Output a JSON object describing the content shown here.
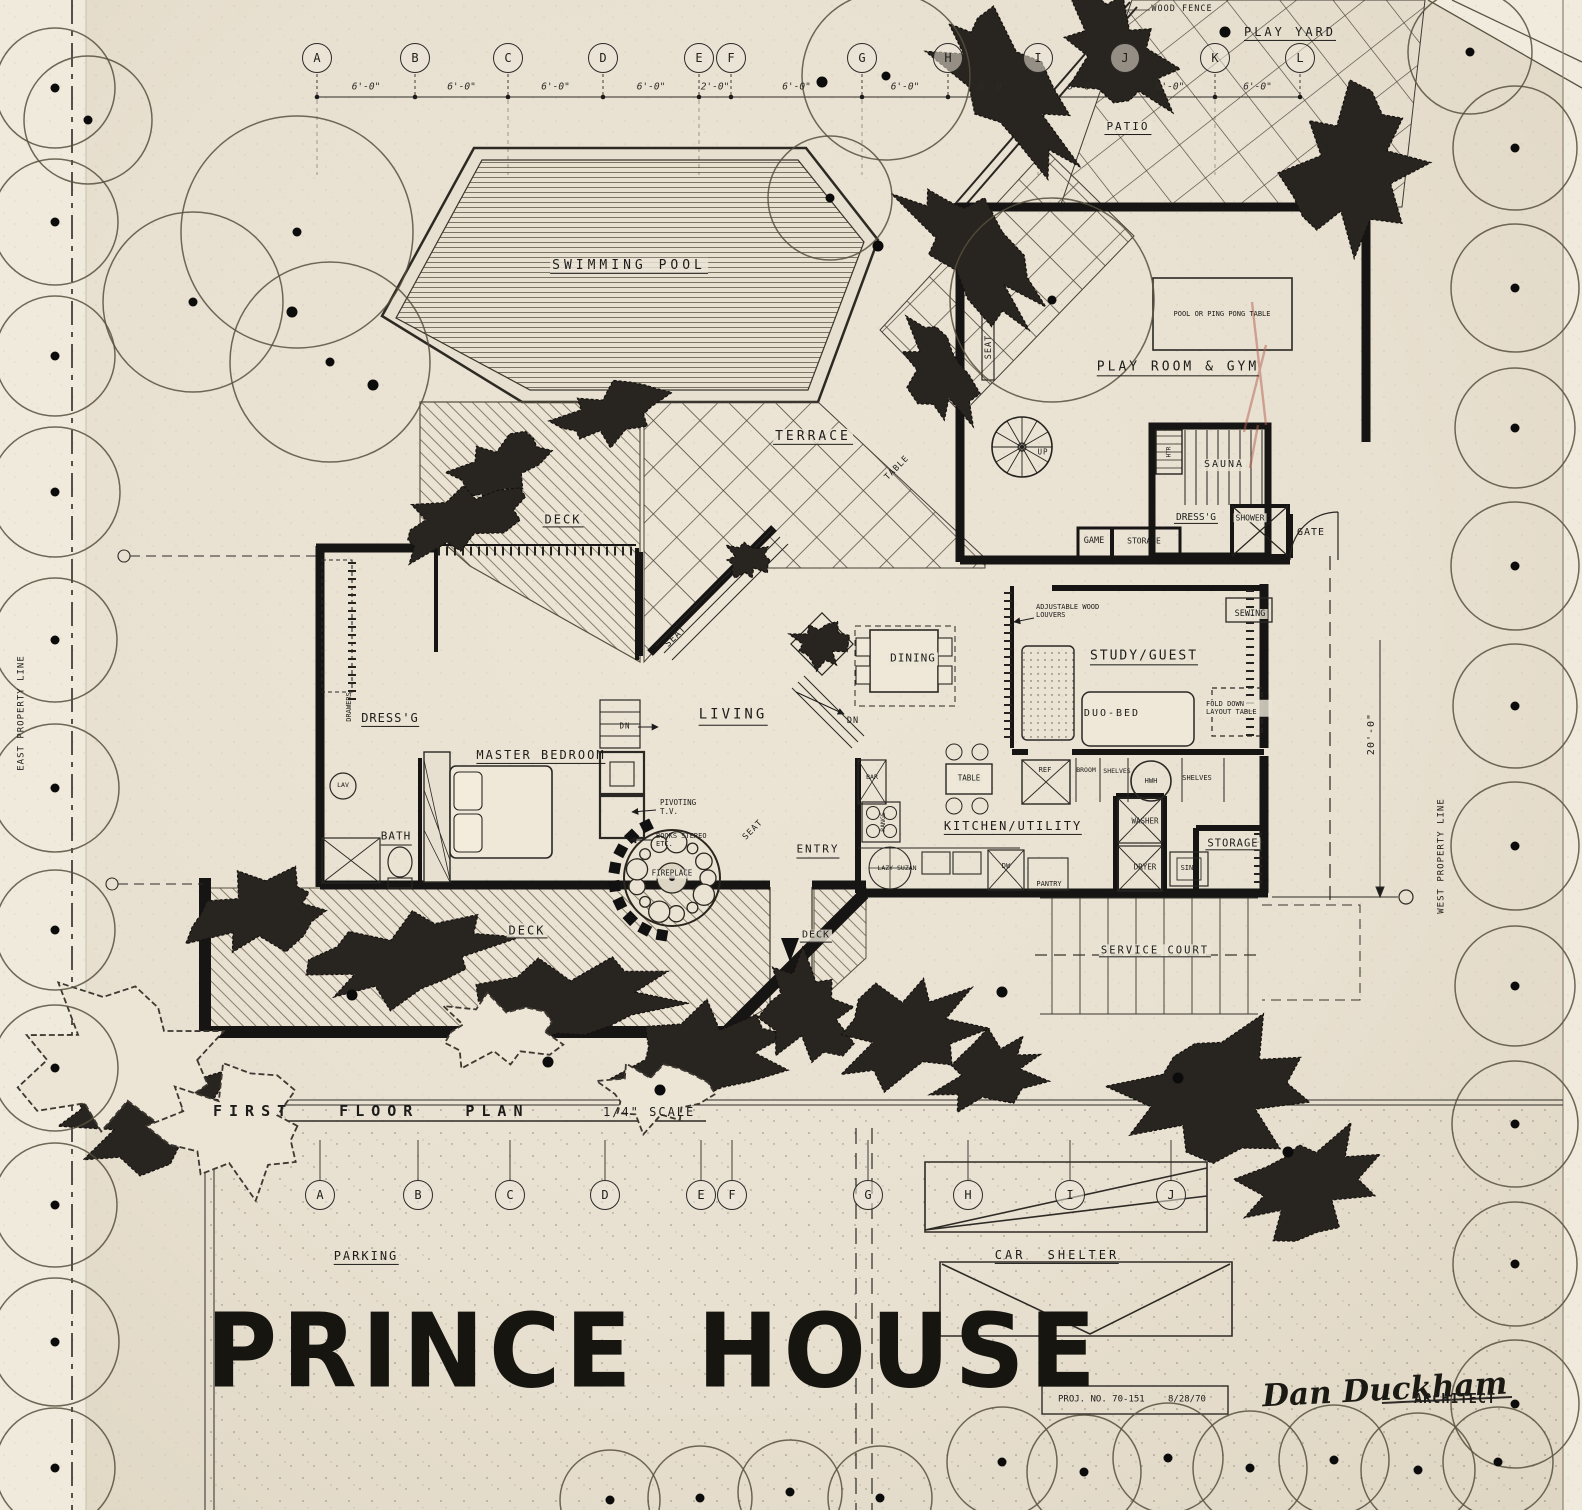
{
  "colors": {
    "paper": "#eae2d2",
    "ink": "#1c1c1c",
    "red_pencil": "#b2604f"
  },
  "title_block": {
    "title": "PRINCE HOUSE",
    "project_no": "PROJ. NO. 70-151",
    "date": "8/28/70",
    "signature": "Dan Duckham",
    "architect": "ARCHITECT"
  },
  "plan_title": {
    "name": "FIRST FLOOR PLAN",
    "scale": "1/4\" SCALE"
  },
  "grid": {
    "top_letters": [
      "A",
      "B",
      "C",
      "D",
      "E",
      "F",
      "G",
      "H",
      "I",
      "J",
      "K",
      "L"
    ],
    "top_dims": [
      "6'-0\"",
      "6'-0\"",
      "6'-0\"",
      "6'-0\"",
      "2'-0\"",
      "6'-0\"",
      "6'-0\"",
      "6'-0\"",
      "6'-0\"",
      "6'-0\"",
      "6'-0\""
    ],
    "bottom_letters": [
      "A",
      "B",
      "C",
      "D",
      "E",
      "F",
      "G",
      "H",
      "I",
      "J"
    ]
  },
  "site": {
    "wood_fence": "WOOD FENCE",
    "play_yard": "PLAY YARD",
    "patio": "PATIO",
    "gate": "GATE",
    "service_court": "SERVICE COURT",
    "parking": "PARKING",
    "car_shelter": "CAR SHELTER",
    "east_property_line": "EAST PROPERTY LINE",
    "west_property_line": "WEST PROPERTY LINE",
    "dim_20ft": "20'-0\""
  },
  "rooms": {
    "swimming_pool": "SWIMMING POOL",
    "terrace": "TERRACE",
    "deck": "DECK",
    "play_room": "PLAY ROOM & GYM",
    "sauna": "SAUNA",
    "living": "LIVING",
    "dining": "DINING",
    "entry": "ENTRY",
    "master_bedroom": "MASTER BEDROOM",
    "dressing": "DRESS'G",
    "bath": "BATH",
    "kitchen_utility": "KITCHEN/UTILITY",
    "study_guest": "STUDY/GUEST",
    "storage": "STORAGE"
  },
  "annotations": {
    "pool_table": "POOL OR PING PONG TABLE",
    "table": "TABLE",
    "seat": "SEAT",
    "up": "UP",
    "dn": "DN",
    "dress_outdoor": "DRESS'G",
    "shower": "SHOWER",
    "game": "GAME",
    "storage_small": "STORAGE",
    "adjustable_louvers": "ADJUSTABLE WOOD LOUVERS",
    "sewing": "SEWING",
    "duo_bed": "DUO-BED",
    "fold_down": "FOLD DOWN LAYOUT TABLE",
    "drawers": "DRAWERS",
    "lav": "LAV",
    "pivoting_tv": "PIVOTING T.V.",
    "books_stereo": "BOOKS STEREO ETC.",
    "fireplace": "FIREPLACE",
    "bar": "BAR",
    "range": "RANGE",
    "ref": "REF",
    "broom": "BROOM",
    "shelves": "SHELVES",
    "hwh": "HWH",
    "washer": "WASHER",
    "dryer": "DRYER",
    "sink": "SINK",
    "pantry": "PANTRY",
    "dw": "DW",
    "lazy_suzan": "LAZY SUZAN",
    "htr": "HTR"
  }
}
